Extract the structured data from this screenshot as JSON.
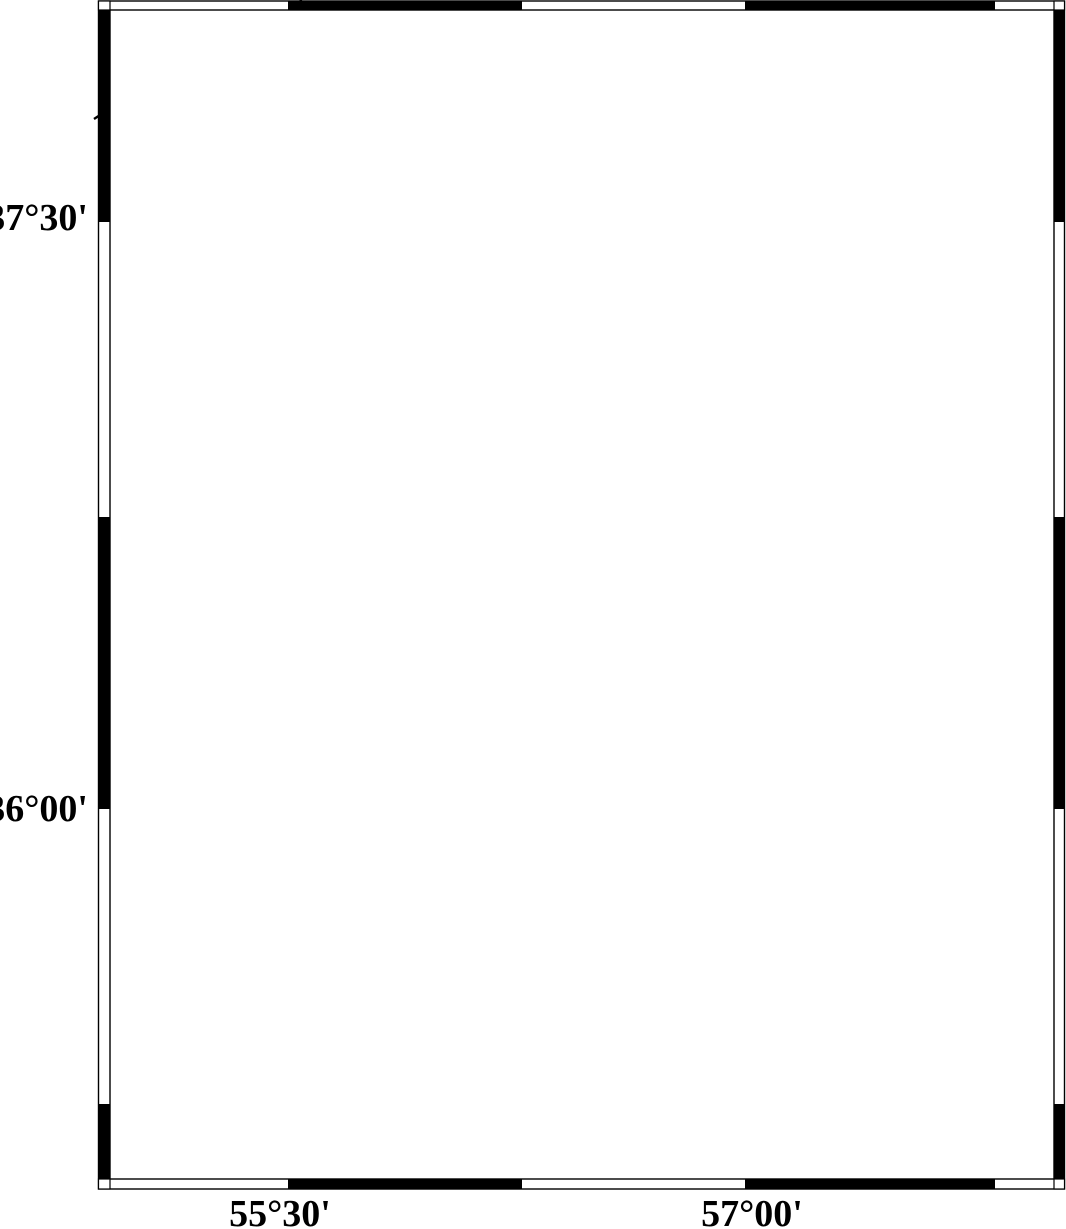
{
  "map": {
    "axis_labels": {
      "lat": [
        {
          "text": "37°30'",
          "y": 218
        },
        {
          "text": "36°00'",
          "y": 809
        }
      ],
      "lon": [
        {
          "text": "55°30'",
          "x": 280
        },
        {
          "text": "57°00'",
          "x": 752
        }
      ]
    },
    "scale_bar": {
      "label": "60 km"
    },
    "legend": {
      "title": "Magnitude",
      "entries": [
        {
          "label": "3",
          "radius": 10,
          "y": 973
        },
        {
          "label": "4",
          "radius": 14,
          "y": 1011
        },
        {
          "label": "5",
          "radius": 19,
          "y": 1052
        },
        {
          "label": "6",
          "radius": 22,
          "y": 1089
        },
        {
          "label": "7",
          "radius": 26,
          "y": 1127
        }
      ]
    },
    "earthquakes": [
      {
        "x": 825,
        "y": 127,
        "r": 18.5
      },
      {
        "x": 838,
        "y": 137,
        "r": 11
      },
      {
        "x": 839,
        "y": 155,
        "r": 10
      },
      {
        "x": 822,
        "y": 166,
        "r": 11
      },
      {
        "x": 854,
        "y": 175,
        "r": 9
      },
      {
        "x": 581,
        "y": 600,
        "r": 10.5
      }
    ],
    "stations": [
      {
        "x": 477,
        "y": 157
      },
      {
        "x": 891,
        "y": 142
      },
      {
        "x": 450,
        "y": 802
      }
    ],
    "colors": {
      "earthquake_fill": "#ff0000",
      "station_fill": "#c3c3c3",
      "line": "#000000"
    }
  }
}
